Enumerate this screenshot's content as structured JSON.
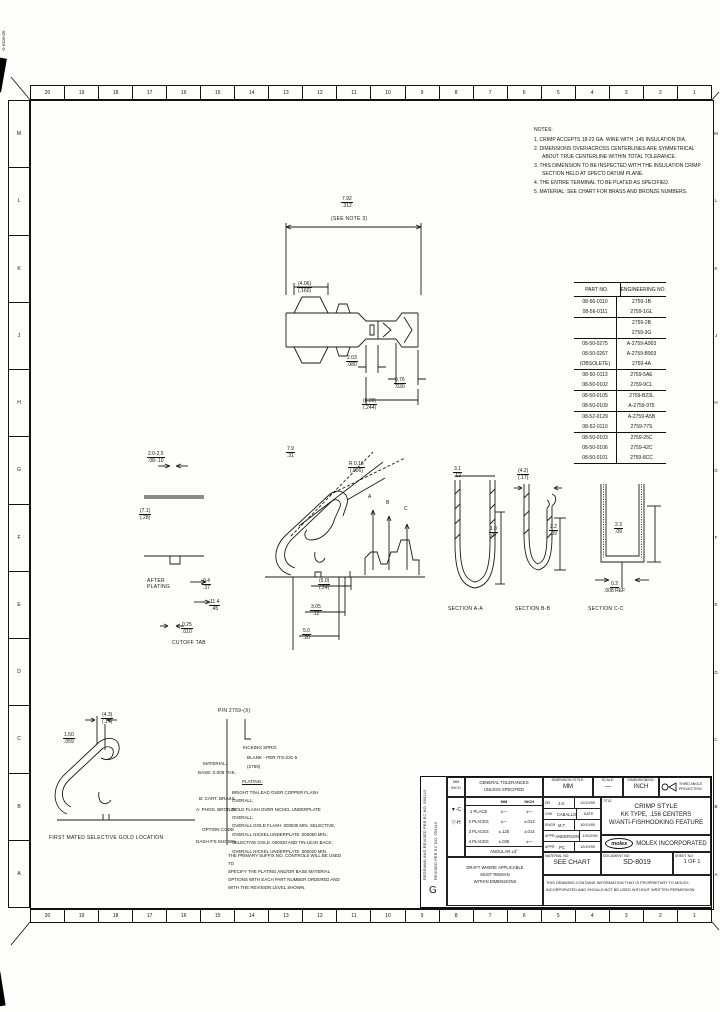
{
  "artifacts": {
    "corner_text": "SD-8019-G",
    "stamp_line1": "K-845",
    "stamp_line2": "(7/92)"
  },
  "zones": {
    "top": [
      "20",
      "19",
      "18",
      "17",
      "16",
      "15",
      "14",
      "13",
      "12",
      "11",
      "10",
      "9",
      "8",
      "7",
      "6",
      "5",
      "4",
      "3",
      "2",
      "1"
    ],
    "bottom": [
      "20",
      "19",
      "18",
      "17",
      "16",
      "15",
      "14",
      "13",
      "12",
      "11",
      "10",
      "9",
      "8",
      "7",
      "6",
      "5",
      "4",
      "3",
      "2",
      "1"
    ],
    "left": [
      "M",
      "L",
      "K",
      "J",
      "H",
      "G",
      "F",
      "E",
      "D",
      "C",
      "B",
      "A"
    ],
    "right": [
      "M",
      "L",
      "K",
      "J",
      "H",
      "G",
      "F",
      "E",
      "D",
      "C",
      "B",
      "A"
    ]
  },
  "notes": {
    "heading": "NOTES:",
    "items": [
      "1. CRIMP ACCEPTS 18-22 GA. WIRE WITH .145 INSULATION DIA.",
      "2. DIMENSIONS OVER/ACROSS CENTERLINES ARE SYMMETRICAL ABOUT TRUE CENTERLINE WITHIN TOTAL TOLERANCE.",
      "3. THIS DIMENSION TO BE INSPECTED WITH THE INSULATION CRIMP SECTION HELD AT SPEC'D DATUM PLANE.",
      "4. THE ENTIRE TERMINAL TO BE PLATED AS SPECIFIED.",
      "5. MATERIAL: SEE CHART FOR BRASS AND BRONZE NUMBERS."
    ]
  },
  "parts_table": {
    "col1": "PART NO.",
    "col2": "ENGINEERING NO.",
    "rows": [
      {
        "p": "08-56-0110",
        "e": "2759-1B"
      },
      {
        "p": "08-56-0111",
        "e": "2759-1GL",
        "sep": true
      },
      {
        "p": "",
        "e": "2759-2B"
      },
      {
        "p": "",
        "e": "2759-3G",
        "sep": true
      },
      {
        "p": "08-50-0275",
        "e": "A-2759-A903"
      },
      {
        "p": "08-50-0267",
        "e": "A-2759-B903"
      },
      {
        "p": "(OBSOLETE)",
        "e": "2759-4A",
        "sep": true
      },
      {
        "p": "08-50-0113",
        "e": "2759-5AE"
      },
      {
        "p": "08-50-0102",
        "e": "2759-9CL",
        "sep": true
      },
      {
        "p": "08-50-0105",
        "e": "2759-B23L"
      },
      {
        "p": "08-50-0109",
        "e": "A-2759-975",
        "sep": true
      },
      {
        "p": "08-52-0129",
        "e": "A-2759-A5B"
      },
      {
        "p": "08-52-0110",
        "e": "2759-77S",
        "sep": true
      },
      {
        "p": "08-50-0103",
        "e": "2759-25C"
      },
      {
        "p": "08-50-0106",
        "e": "2759-42C"
      },
      {
        "p": "08-50-0101",
        "e": "2759-8CC",
        "sep": true
      }
    ]
  },
  "dims": {
    "plan": {
      "overall": {
        "mm": "7.92",
        "in": ".312"
      },
      "note": "(SEE NOTE 3)",
      "left": {
        "mm": "(4.06)",
        "in": "(.160)"
      },
      "mid": {
        "mm": "2.03",
        "in": ".080"
      },
      "right": {
        "mm": "0.76",
        "in": ".030"
      },
      "bottom": {
        "mm": "(6.20)",
        "in": "(.244)"
      }
    },
    "side": {
      "diag": {
        "mm": "7.9",
        "in": ".31"
      },
      "radius": {
        "mm": "R 0.15",
        "in": "(.006)"
      },
      "d1": {
        "mm": "(6.0)",
        "in": "(.24)"
      },
      "d2": {
        "mm": "3.05",
        "in": ".12"
      },
      "d3": {
        "mm": "5.0",
        "in": ".20"
      },
      "letters": [
        "A",
        "B",
        "C"
      ]
    },
    "detail": {
      "d1": {
        "mm": "2.0-2.5",
        "in": ".08-.10"
      },
      "d2": {
        "mm": "(7.1)",
        "in": "(.28)"
      },
      "after_plating": "AFTER\nPLATING",
      "d3": {
        "mm": "9.4",
        "in": ".37"
      },
      "d4": {
        "mm": "11.4",
        "in": ".45"
      },
      "d5": {
        "mm": "0.25",
        "in": ".010"
      },
      "caption": "CUTOFF TAB"
    },
    "sections": {
      "a": {
        "caption": "SECTION A-A",
        "w": {
          "mm": "3.1",
          "in": ".12"
        },
        "h": {
          "mm": "1.8",
          "in": ".07"
        }
      },
      "b": {
        "caption": "SECTION B-B",
        "w": {
          "mm": "(4.2)",
          "in": "(.17)"
        },
        "h": {
          "mm": "2.2",
          "in": ".09"
        }
      },
      "c": {
        "caption": "SECTION C-C",
        "h": {
          "mm": "2.3",
          "in": ".09"
        },
        "b": {
          "mm": "0.2",
          "in": ".008 REF"
        }
      }
    },
    "mating": {
      "d1": {
        "mm": "(4.3)",
        "in": "(.17)"
      },
      "d2": {
        "mm": "1.50",
        "in": ".059"
      },
      "caption": "FIRST MATED SELECTIVE GOLD LOCATION"
    }
  },
  "material_block": {
    "pn_note": "P/N 2759-(X)",
    "left": [
      "MATERIAL:",
      "BASE: 0.008 THK.",
      "B: CART. BRASS",
      "A: PHOS. BRONZE",
      "OPTION CODE",
      "DASH #'S SHOWN"
    ],
    "kicking_heading": "KICKING SPRG:",
    "kicking_sub": "BLANK - PER ITS-231-5",
    "kicking_sub2": "(2759)",
    "plating_heading": "PLATING:",
    "plating_lines": [
      "BRIGHT TIN-LEAD OVER COPPER FLASH OVERALL;",
      "GOLD FLASH OVER NICKEL UNDERPLATE OVERALL;",
      "OVERALL GOLD FLASH .000030 MIN. SELECTIVE;",
      "OVERALL NICKEL UNDERPLATE .000050 MIN.;",
      "SELECTIVE GOLD .000030 AND TIN-LEAD BACK;",
      "OVERALL NICKEL UNDERPLATE .000020 MIN."
    ],
    "footer_lines": [
      "THE PRIMARY SUFFIX NO. CONTROLS WILL BE USED TO",
      "SPECIFY THE PLATING AND/OR BASE MATERIAL",
      "OPTIONS WITH EACH PART NUMBER ORDERED AND",
      "WITH THE REVISION LEVEL SHOWN."
    ]
  },
  "title_block": {
    "rev_text1": "REDRAWN AND REVISED PER EC NO. 960143",
    "rev_text2": "REVISED PER EC NO. 953310",
    "rev_letter": "G",
    "units_top": "MM",
    "units_bottom": "INCH",
    "tol_heading1": "GENERAL TOLERANCES",
    "tol_heading2": "UNLESS SPECIFIED",
    "tol_col_mm": "MM",
    "tol_col_inch": "INCH",
    "tol_rows": [
      {
        "label": "1 PLACE",
        "mm": "±—",
        "inch": "±—"
      },
      {
        "label": "2 PLACES",
        "mm": "±—",
        "inch": "±.013"
      },
      {
        "label": "3 PLACES",
        "mm": "±.125",
        "inch": "±.014"
      },
      {
        "label": "4 PLACES",
        "mm": "±.038",
        "inch": "±—"
      }
    ],
    "tol_angular": "ANGULAR ±3°",
    "mark1": "▼-C",
    "mark2": "▽-H",
    "dim_style_label": "DIMENSION STYLE:",
    "dim_style": "MM",
    "scale_label": "SCALE:",
    "scale": "—",
    "dimensioning_label": "DIMENSIONING:",
    "dimensioning": "INCH",
    "projection_label": "THIRD ANGLE PROJECTION",
    "approvals": [
      {
        "role": "DR",
        "name": "J.S.",
        "date": "10/10/95"
      },
      {
        "role": "CHK",
        "name": "CABALLO",
        "date": "DATE"
      },
      {
        "role": "ENGR",
        "name": "M.T.",
        "date": "10/10/95"
      },
      {
        "role": "APPR",
        "name": "ANDERSON",
        "date": "10/10/95"
      },
      {
        "role": "APPR",
        "name": ".PC",
        "date": "10/10/95"
      }
    ],
    "title_label": "TITLE",
    "title_line1": "CRIMP STYLE",
    "title_line2": "KK TYPE, .156 CENTERS",
    "title_line3": "W/ANTI-FISHHOOKING FEATURE",
    "logo_text": "molex",
    "company": "MOLEX INCORPORATED",
    "material_label": "MATERIAL NO:",
    "material": "SEE CHART",
    "doc_label": "DOCUMENT NO:",
    "doc": "SD-8019",
    "sheet_label": "SHEET NO:",
    "sheet": "1 OF 1",
    "proprietary_line1": "THIS DRAWING CONTAINS INFORMATION THAT IS PROPRIETARY TO MOLEX",
    "proprietary_line2": "INCORPORATED AND SHOULD NOT BE USED WITHOUT WRITTEN PERMISSION",
    "draft_line1": "DRAFT WHERE APPLICABLE",
    "draft_line2": "MUST REMAIN",
    "draft_line3": "WITHIN DIMENSIONS"
  }
}
